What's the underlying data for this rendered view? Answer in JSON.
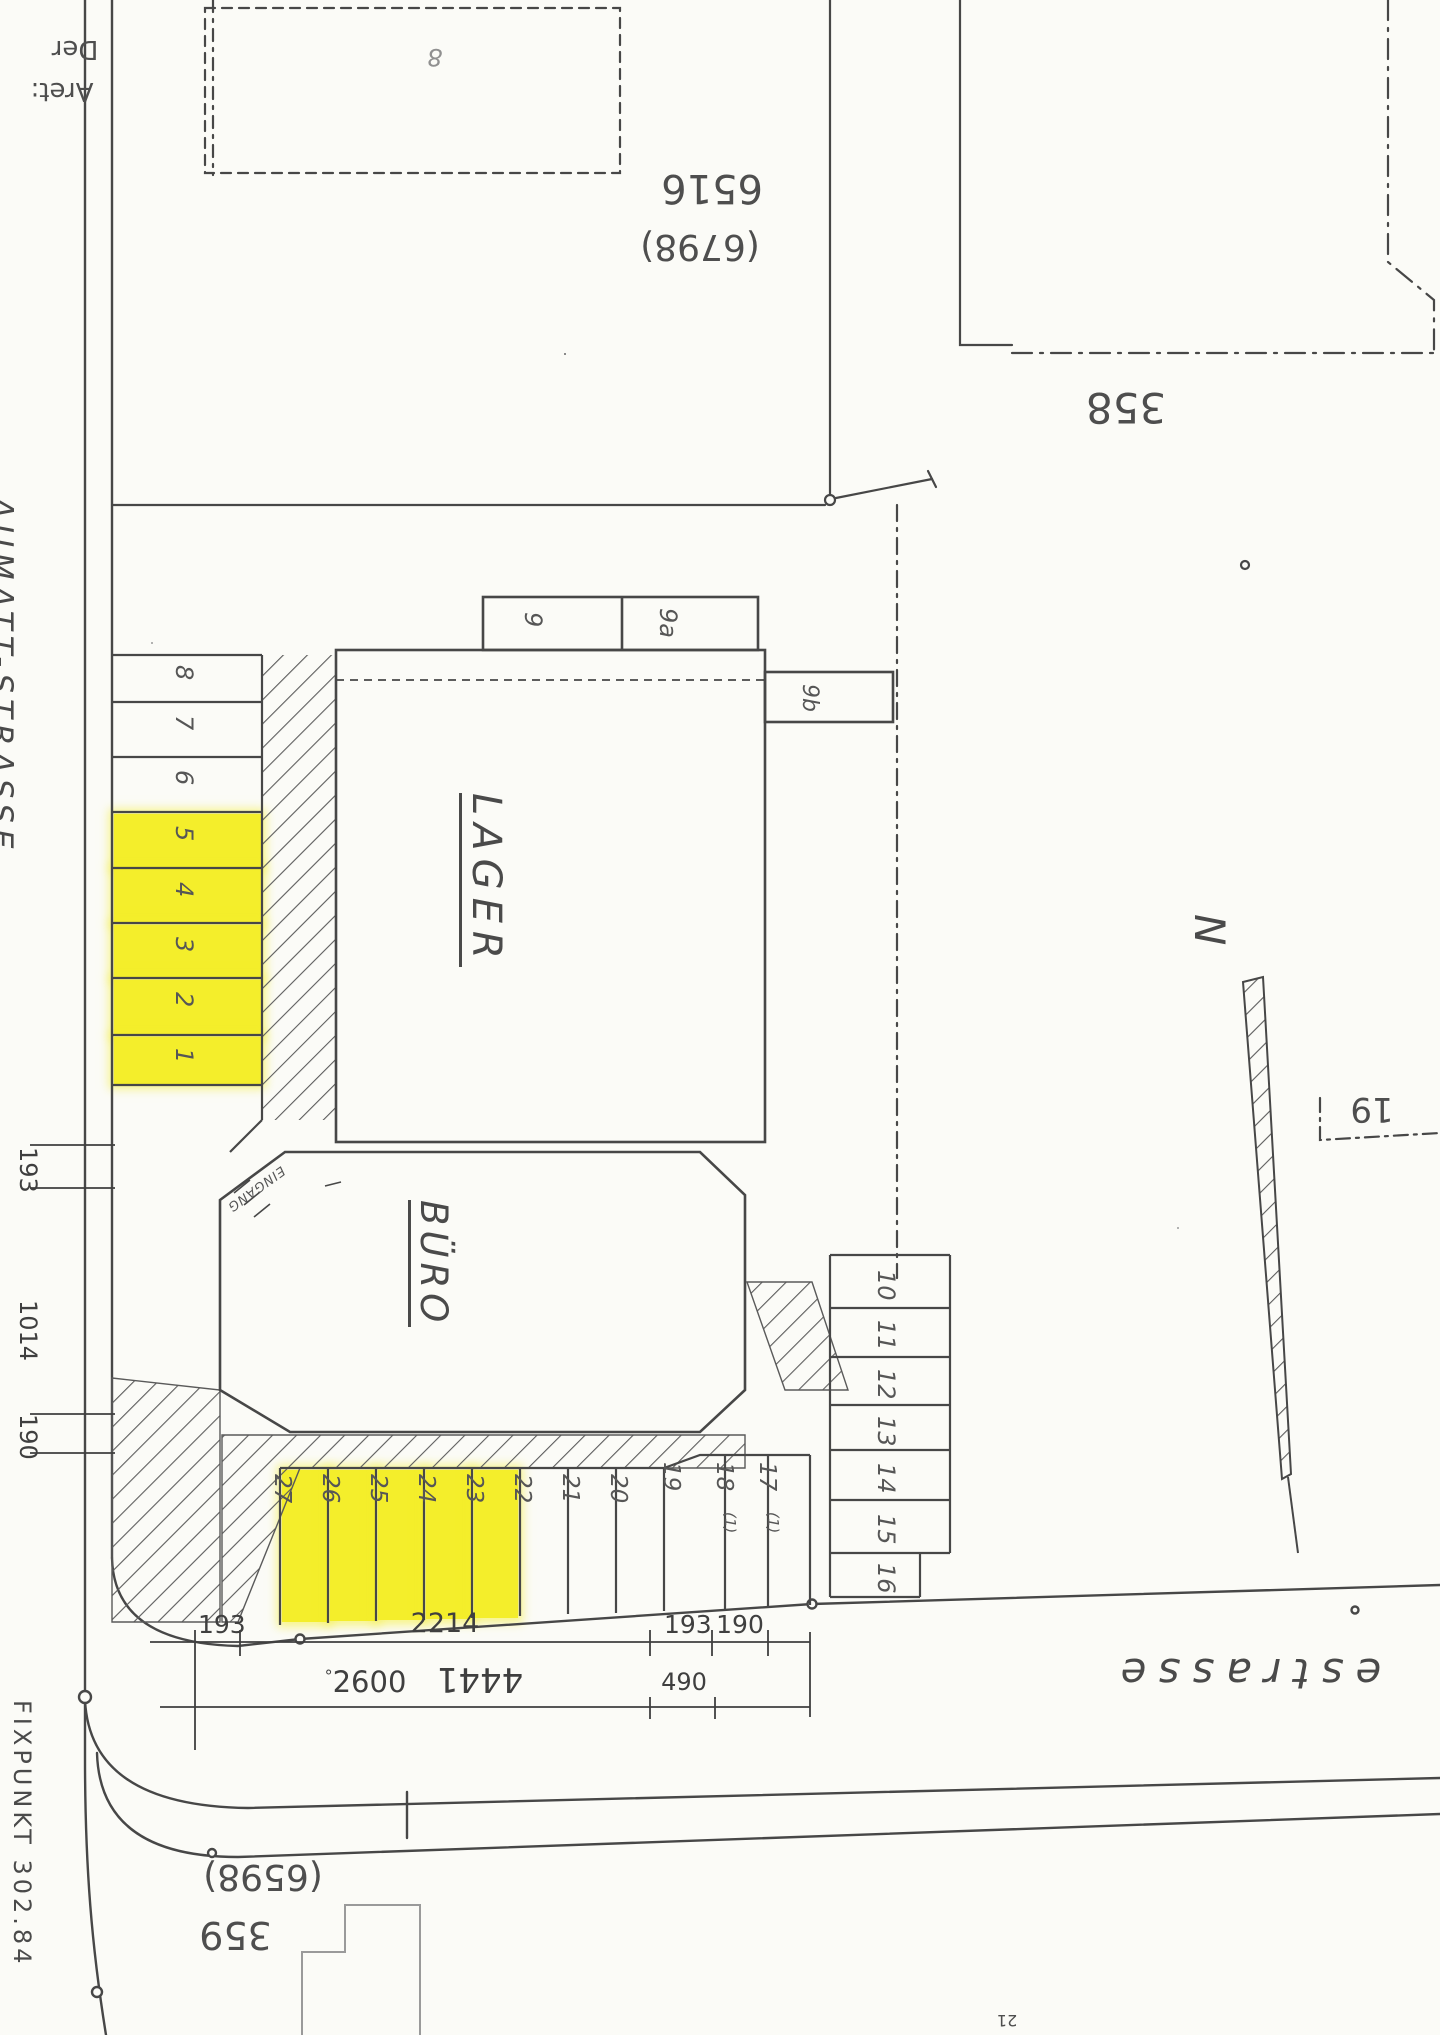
{
  "page": {
    "background": "#fbfbf7",
    "ink": "#474747",
    "highlight": "#f4ee2b"
  },
  "labels": {
    "street_left": "AUMATT-STRASSE",
    "street_bottom": "estrasse",
    "corner_note_line1": "Der",
    "corner_note_line2": "Aret:",
    "building_lager": "LAGER",
    "building_buero": "BÜRO",
    "entrance": "EINGANG",
    "shed_note": "8",
    "north": "N",
    "fixpoint": "FIXPUNKT 302.84",
    "parcel_6516": "6516",
    "parcel_6516_alt": "(6798)",
    "parcel_358": "358",
    "parcel_19": "19",
    "parcel_359": "359",
    "parcel_359_alt": "(6598)",
    "parcel_21": "21"
  },
  "stalls": {
    "left": [
      "8",
      "7",
      "6",
      "5",
      "4",
      "3",
      "2",
      "1"
    ],
    "top": [
      "9",
      "9a",
      "9b"
    ],
    "right": [
      "10",
      "11",
      "12",
      "13",
      "14",
      "15",
      "16"
    ],
    "bottom": [
      "27",
      "26",
      "25",
      "24",
      "23",
      "22",
      "21",
      "20",
      "19",
      "18",
      "17"
    ],
    "note_18": "(1)",
    "note_17": "(1)",
    "highlighted_left": [
      "1",
      "2",
      "3",
      "4",
      "5"
    ],
    "highlighted_bottom": [
      "23",
      "24",
      "25",
      "26",
      "27"
    ]
  },
  "dimensions": {
    "row1": [
      "193",
      "2214",
      "193",
      "190"
    ],
    "row2_mark": "°",
    "row2_prefix": "2600",
    "row2_main": "4441",
    "row2_right": "490",
    "left": [
      "193",
      "1014",
      "190"
    ]
  }
}
